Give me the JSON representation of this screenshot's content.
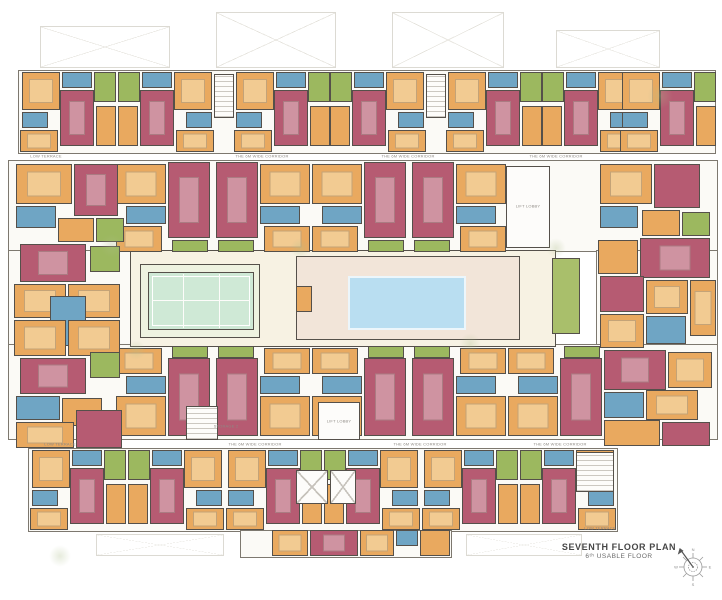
{
  "title_block": {
    "title": "SEVENTH FLOOR PLAN",
    "subtitle": "6ᵗʰ USABLE FLOOR"
  },
  "palette": {
    "wall": "#55504a",
    "ground": "#f7f2e3",
    "courtapron": "#eef2e0",
    "tennis": "#cfe9d6",
    "pool": "#b9def1",
    "deck": "#f2e5d9",
    "hallgreen": "#a9bf6b",
    "orange": "#e9a95f",
    "orange_light": "#f2cb92",
    "pink": "#b65b72",
    "pink_light": "#cf93a1",
    "blue": "#6fa5c4",
    "blue_light": "#a6c8da",
    "green": "#9cb85f",
    "green_light": "#bacd85",
    "white": "#fdfcfa"
  },
  "floor_plan": {
    "terraces": [
      {
        "x": 40,
        "y": 26,
        "w": 130,
        "h": 42
      },
      {
        "x": 216,
        "y": 12,
        "w": 120,
        "h": 56
      },
      {
        "x": 392,
        "y": 12,
        "w": 112,
        "h": 56
      },
      {
        "x": 556,
        "y": 30,
        "w": 104,
        "h": 38
      },
      {
        "x": 96,
        "y": 534,
        "w": 128,
        "h": 22
      },
      {
        "x": 466,
        "y": 534,
        "w": 116,
        "h": 22
      }
    ],
    "slabs": [
      {
        "x": 18,
        "y": 70,
        "w": 698,
        "h": 84
      },
      {
        "x": 8,
        "y": 160,
        "w": 710,
        "h": 92
      },
      {
        "x": 8,
        "y": 250,
        "w": 128,
        "h": 98
      },
      {
        "x": 596,
        "y": 250,
        "w": 122,
        "h": 98
      },
      {
        "x": 8,
        "y": 344,
        "w": 710,
        "h": 96
      },
      {
        "x": 28,
        "y": 448,
        "w": 590,
        "h": 84
      },
      {
        "x": 240,
        "y": 530,
        "w": 212,
        "h": 28
      }
    ],
    "base": [
      {
        "x": 130,
        "y": 250,
        "w": 426,
        "h": 97,
        "c": "ground",
        "n": "courtyard"
      },
      {
        "x": 140,
        "y": 264,
        "w": 120,
        "h": 74,
        "c": "courtapron",
        "n": "tennis-apron"
      },
      {
        "x": 148,
        "y": 272,
        "w": 106,
        "h": 58,
        "c": "tennis",
        "n": "tennis-court"
      },
      {
        "x": 152,
        "y": 276,
        "w": 98,
        "h": 50,
        "cls": "wline",
        "n": "tennis-court-line"
      },
      {
        "x": 183,
        "y": 274,
        "w": 1,
        "h": 54,
        "c": "white",
        "nb": 1,
        "n": "tennis-net-line"
      },
      {
        "x": 219,
        "y": 274,
        "w": 1,
        "h": 54,
        "c": "white",
        "nb": 1,
        "n": "tennis-net-line"
      },
      {
        "x": 152,
        "y": 300,
        "w": 98,
        "h": 1,
        "c": "white",
        "nb": 1,
        "n": "tennis-court-line"
      },
      {
        "x": 296,
        "y": 256,
        "w": 224,
        "h": 84,
        "c": "deck",
        "cls": "deck",
        "n": "pool-deck"
      },
      {
        "x": 296,
        "y": 286,
        "w": 16,
        "h": 26,
        "c": "orange",
        "n": "deck-cabin"
      },
      {
        "x": 348,
        "y": 276,
        "w": 118,
        "h": 54,
        "c": "pool",
        "cls": "pool",
        "n": "swimming-pool"
      },
      {
        "x": 552,
        "y": 258,
        "w": 28,
        "h": 76,
        "c": "hallgreen",
        "n": "multipurpose-hall"
      }
    ],
    "unit_templates": {
      "row": {
        "w": 96,
        "h": 80,
        "rooms": [
          {
            "x": 2,
            "y": 0,
            "w": 38,
            "h": 38,
            "c": "orange",
            "f": "bed",
            "n": "bedroom"
          },
          {
            "x": 42,
            "y": 0,
            "w": 30,
            "h": 16,
            "c": "blue",
            "n": "bathroom"
          },
          {
            "x": 74,
            "y": 0,
            "w": 22,
            "h": 30,
            "c": "green",
            "n": "balcony"
          },
          {
            "x": 40,
            "y": 18,
            "w": 34,
            "h": 56,
            "c": "pink",
            "f": "table",
            "n": "living-dining"
          },
          {
            "x": 2,
            "y": 40,
            "w": 26,
            "h": 16,
            "c": "blue",
            "n": "bathroom"
          },
          {
            "x": 0,
            "y": 58,
            "w": 38,
            "h": 22,
            "c": "orange",
            "f": "bed",
            "n": "bedroom"
          },
          {
            "x": 76,
            "y": 34,
            "w": 20,
            "h": 40,
            "c": "orange",
            "n": "bedroom"
          }
        ]
      },
      "down": {
        "w": 96,
        "h": 90,
        "rooms": [
          {
            "x": 52,
            "y": 0,
            "w": 42,
            "h": 76,
            "c": "pink",
            "f": "table",
            "n": "living-dining"
          },
          {
            "x": 0,
            "y": 2,
            "w": 50,
            "h": 40,
            "c": "orange",
            "f": "bed",
            "n": "bedroom"
          },
          {
            "x": 10,
            "y": 44,
            "w": 40,
            "h": 18,
            "c": "blue",
            "n": "bathroom"
          },
          {
            "x": 0,
            "y": 64,
            "w": 46,
            "h": 26,
            "c": "orange",
            "f": "bed",
            "n": "bedroom"
          },
          {
            "x": 56,
            "y": 78,
            "w": 36,
            "h": 12,
            "c": "green",
            "n": "balcony"
          }
        ]
      },
      "up": {
        "w": 96,
        "h": 92,
        "rooms": [
          {
            "x": 56,
            "y": 0,
            "w": 36,
            "h": 12,
            "c": "green",
            "n": "balcony"
          },
          {
            "x": 52,
            "y": 12,
            "w": 42,
            "h": 78,
            "c": "pink",
            "f": "table",
            "n": "living-dining"
          },
          {
            "x": 0,
            "y": 2,
            "w": 46,
            "h": 26,
            "c": "orange",
            "f": "bed",
            "n": "bedroom"
          },
          {
            "x": 10,
            "y": 30,
            "w": 40,
            "h": 18,
            "c": "blue",
            "n": "bathroom"
          },
          {
            "x": 0,
            "y": 50,
            "w": 50,
            "h": 40,
            "c": "orange",
            "f": "bed",
            "n": "bedroom"
          }
        ]
      }
    },
    "units": [
      {
        "t": "row",
        "x": 20,
        "y": 72
      },
      {
        "t": "row",
        "x": 118,
        "y": 72,
        "flip": true
      },
      {
        "t": "row",
        "x": 234,
        "y": 72
      },
      {
        "t": "row",
        "x": 330,
        "y": 72,
        "flip": true
      },
      {
        "t": "row",
        "x": 446,
        "y": 72
      },
      {
        "t": "row",
        "x": 542,
        "y": 72,
        "flip": true
      },
      {
        "t": "row",
        "x": 620,
        "y": 72
      },
      {
        "t": "down",
        "x": 116,
        "y": 162
      },
      {
        "t": "down",
        "x": 214,
        "y": 162,
        "flip": true
      },
      {
        "t": "down",
        "x": 312,
        "y": 162
      },
      {
        "t": "down",
        "x": 410,
        "y": 162,
        "flip": true
      },
      {
        "t": "up",
        "x": 116,
        "y": 346
      },
      {
        "t": "up",
        "x": 214,
        "y": 346,
        "flip": true
      },
      {
        "t": "up",
        "x": 312,
        "y": 346
      },
      {
        "t": "up",
        "x": 410,
        "y": 346,
        "flip": true
      },
      {
        "t": "up",
        "x": 508,
        "y": 346
      },
      {
        "t": "row",
        "x": 30,
        "y": 450
      },
      {
        "t": "row",
        "x": 128,
        "y": 450,
        "flip": true
      },
      {
        "t": "row",
        "x": 226,
        "y": 450
      },
      {
        "t": "row",
        "x": 324,
        "y": 450,
        "flip": true
      },
      {
        "t": "row",
        "x": 422,
        "y": 450
      },
      {
        "t": "row",
        "x": 520,
        "y": 450,
        "flip": true
      }
    ],
    "rooms": [
      {
        "x": 16,
        "y": 164,
        "w": 56,
        "h": 40,
        "c": "orange",
        "f": "bed",
        "n": "bedroom"
      },
      {
        "x": 74,
        "y": 164,
        "w": 44,
        "h": 52,
        "c": "pink",
        "f": "table",
        "n": "living-dining"
      },
      {
        "x": 16,
        "y": 206,
        "w": 40,
        "h": 22,
        "c": "blue",
        "n": "bathroom"
      },
      {
        "x": 58,
        "y": 218,
        "w": 36,
        "h": 24,
        "c": "orange",
        "n": "bedroom"
      },
      {
        "x": 96,
        "y": 218,
        "w": 28,
        "h": 24,
        "c": "green",
        "n": "balcony"
      },
      {
        "x": 20,
        "y": 244,
        "w": 66,
        "h": 38,
        "c": "pink",
        "f": "table",
        "n": "living-dining"
      },
      {
        "x": 90,
        "y": 246,
        "w": 30,
        "h": 26,
        "c": "green",
        "n": "balcony"
      },
      {
        "x": 14,
        "y": 284,
        "w": 52,
        "h": 34,
        "c": "orange",
        "f": "bed",
        "n": "bedroom"
      },
      {
        "x": 68,
        "y": 284,
        "w": 52,
        "h": 34,
        "c": "orange",
        "f": "bed",
        "n": "bedroom"
      },
      {
        "x": 50,
        "y": 296,
        "w": 36,
        "h": 50,
        "c": "blue",
        "n": "bathroom"
      },
      {
        "x": 14,
        "y": 320,
        "w": 52,
        "h": 36,
        "c": "orange",
        "f": "bed",
        "n": "bedroom"
      },
      {
        "x": 68,
        "y": 320,
        "w": 52,
        "h": 36,
        "c": "orange",
        "f": "bed",
        "n": "bedroom"
      },
      {
        "x": 20,
        "y": 358,
        "w": 66,
        "h": 36,
        "c": "pink",
        "f": "table",
        "n": "living-dining"
      },
      {
        "x": 90,
        "y": 352,
        "w": 30,
        "h": 26,
        "c": "green",
        "n": "balcony"
      },
      {
        "x": 16,
        "y": 396,
        "w": 44,
        "h": 24,
        "c": "blue",
        "n": "bathroom"
      },
      {
        "x": 62,
        "y": 398,
        "w": 40,
        "h": 28,
        "c": "orange",
        "n": "bedroom"
      },
      {
        "x": 16,
        "y": 422,
        "w": 58,
        "h": 26,
        "c": "orange",
        "f": "bed",
        "n": "bedroom"
      },
      {
        "x": 76,
        "y": 410,
        "w": 46,
        "h": 38,
        "c": "pink",
        "n": "living-dining"
      },
      {
        "x": 600,
        "y": 164,
        "w": 52,
        "h": 40,
        "c": "orange",
        "f": "bed",
        "n": "bedroom"
      },
      {
        "x": 654,
        "y": 164,
        "w": 46,
        "h": 44,
        "c": "pink",
        "n": "living-dining"
      },
      {
        "x": 600,
        "y": 206,
        "w": 38,
        "h": 22,
        "c": "blue",
        "n": "bathroom"
      },
      {
        "x": 642,
        "y": 210,
        "w": 38,
        "h": 26,
        "c": "orange",
        "n": "bedroom"
      },
      {
        "x": 682,
        "y": 212,
        "w": 28,
        "h": 24,
        "c": "green",
        "n": "balcony"
      },
      {
        "x": 640,
        "y": 238,
        "w": 70,
        "h": 40,
        "c": "pink",
        "f": "table",
        "n": "living-dining"
      },
      {
        "x": 598,
        "y": 240,
        "w": 40,
        "h": 34,
        "c": "orange",
        "n": "bedroom"
      },
      {
        "x": 690,
        "y": 280,
        "w": 26,
        "h": 56,
        "c": "orange",
        "f": "bed",
        "n": "bedroom"
      },
      {
        "x": 600,
        "y": 276,
        "w": 44,
        "h": 36,
        "c": "pink",
        "n": "living-dining"
      },
      {
        "x": 646,
        "y": 280,
        "w": 42,
        "h": 34,
        "c": "orange",
        "f": "bed",
        "n": "bedroom"
      },
      {
        "x": 600,
        "y": 314,
        "w": 44,
        "h": 34,
        "c": "orange",
        "f": "bed",
        "n": "bedroom"
      },
      {
        "x": 646,
        "y": 316,
        "w": 40,
        "h": 28,
        "c": "blue",
        "n": "bathroom"
      },
      {
        "x": 604,
        "y": 350,
        "w": 62,
        "h": 40,
        "c": "pink",
        "f": "table",
        "n": "living-dining"
      },
      {
        "x": 668,
        "y": 352,
        "w": 44,
        "h": 36,
        "c": "orange",
        "f": "bed",
        "n": "bedroom"
      },
      {
        "x": 604,
        "y": 392,
        "w": 40,
        "h": 26,
        "c": "blue",
        "n": "bathroom"
      },
      {
        "x": 646,
        "y": 390,
        "w": 52,
        "h": 30,
        "c": "orange",
        "f": "bed",
        "n": "bedroom"
      },
      {
        "x": 604,
        "y": 420,
        "w": 56,
        "h": 26,
        "c": "orange",
        "n": "bedroom"
      },
      {
        "x": 662,
        "y": 422,
        "w": 48,
        "h": 24,
        "c": "pink",
        "n": "living-dining"
      },
      {
        "x": 214,
        "y": 74,
        "w": 20,
        "h": 44,
        "cls": "stair",
        "n": "staircase"
      },
      {
        "x": 426,
        "y": 74,
        "w": 20,
        "h": 44,
        "cls": "stair",
        "n": "staircase"
      },
      {
        "x": 506,
        "y": 166,
        "w": 44,
        "h": 82,
        "c": "white",
        "n": "lift-lobby"
      },
      {
        "x": 186,
        "y": 406,
        "w": 32,
        "h": 34,
        "cls": "stair",
        "n": "staircase"
      },
      {
        "x": 318,
        "y": 402,
        "w": 42,
        "h": 38,
        "c": "white",
        "n": "lift-lobby"
      },
      {
        "x": 296,
        "y": 470,
        "w": 32,
        "h": 34,
        "cls": "xcore",
        "n": "lift-core"
      },
      {
        "x": 330,
        "y": 470,
        "w": 26,
        "h": 34,
        "cls": "xcore",
        "n": "lift-core"
      },
      {
        "x": 576,
        "y": 452,
        "w": 38,
        "h": 40,
        "cls": "stair",
        "n": "staircase"
      },
      {
        "x": 272,
        "y": 530,
        "w": 36,
        "h": 26,
        "c": "orange",
        "f": "bed",
        "n": "bedroom"
      },
      {
        "x": 310,
        "y": 530,
        "w": 48,
        "h": 26,
        "c": "pink",
        "f": "table",
        "n": "living-dining"
      },
      {
        "x": 360,
        "y": 530,
        "w": 34,
        "h": 26,
        "c": "orange",
        "f": "bed",
        "n": "bedroom"
      },
      {
        "x": 396,
        "y": 530,
        "w": 22,
        "h": 16,
        "c": "blue",
        "n": "bathroom"
      },
      {
        "x": 420,
        "y": 530,
        "w": 30,
        "h": 26,
        "c": "orange",
        "n": "bedroom"
      }
    ],
    "labels": [
      {
        "x": 262,
        "y": 156,
        "t": "THE 6M WIDE CORRIDOR"
      },
      {
        "x": 408,
        "y": 156,
        "t": "THE 6M WIDE CORRIDOR"
      },
      {
        "x": 556,
        "y": 156,
        "t": "THE 6M WIDE CORRIDOR"
      },
      {
        "x": 46,
        "y": 156,
        "t": "LOW TERRACE"
      },
      {
        "x": 255,
        "y": 444,
        "t": "THE 6M WIDE CORRIDOR"
      },
      {
        "x": 420,
        "y": 444,
        "t": "THE 6M WIDE CORRIDOR"
      },
      {
        "x": 560,
        "y": 444,
        "t": "THE 6M WIDE CORRIDOR"
      },
      {
        "x": 60,
        "y": 444,
        "t": "LOW TERRACE"
      },
      {
        "x": 528,
        "y": 206,
        "t": "LIFT LOBBY"
      },
      {
        "x": 339,
        "y": 421,
        "t": "LIFT LOBBY"
      },
      {
        "x": 226,
        "y": 426,
        "t": "STORAGE 2"
      },
      {
        "x": 600,
        "y": 528,
        "t": "LOW TERRACE"
      }
    ],
    "decor": [
      {
        "x": 112,
        "y": 246,
        "r": 12
      },
      {
        "x": 300,
        "y": 248,
        "r": 10
      },
      {
        "x": 470,
        "y": 344,
        "r": 11
      },
      {
        "x": 556,
        "y": 248,
        "r": 10
      },
      {
        "x": 136,
        "y": 350,
        "r": 10
      },
      {
        "x": 660,
        "y": 96,
        "r": 13
      },
      {
        "x": 60,
        "y": 556,
        "r": 11
      }
    ]
  },
  "compass": {
    "letters": [
      "N",
      "E",
      "S",
      "W"
    ]
  }
}
